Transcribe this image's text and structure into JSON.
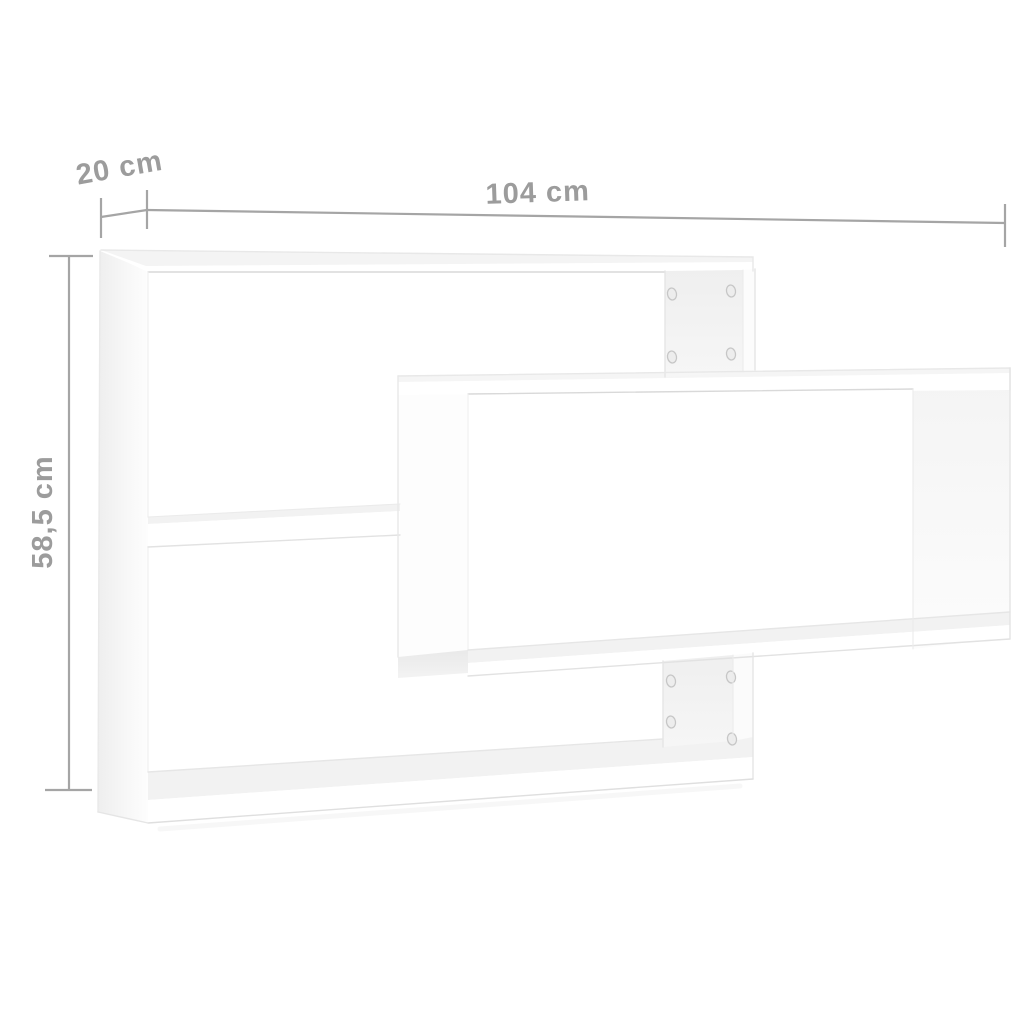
{
  "page": {
    "background": "#ffffff",
    "description": "Product dimension diagram of a white 3-compartment wall shelf"
  },
  "dimensions": {
    "depth": {
      "label": "20 cm"
    },
    "width": {
      "label": "104 cm"
    },
    "height": {
      "label": "58,5 cm"
    }
  },
  "colors": {
    "dimension_line": "#a5a5a5",
    "dimension_text": "#9c9c9c",
    "shelf_white": "#ffffff",
    "shelf_top_face": "#f2f2f2",
    "shelf_inner_face": "#f0f0f0",
    "shelf_underside": "#ebebeb",
    "edge_line": "#e2e2e2",
    "screw_hole_fill": "#ededed",
    "screw_hole_ring": "#c6c6c6"
  },
  "product": {
    "name": "wall shelf",
    "compartments": 3,
    "visible_screw_holes": 8
  }
}
